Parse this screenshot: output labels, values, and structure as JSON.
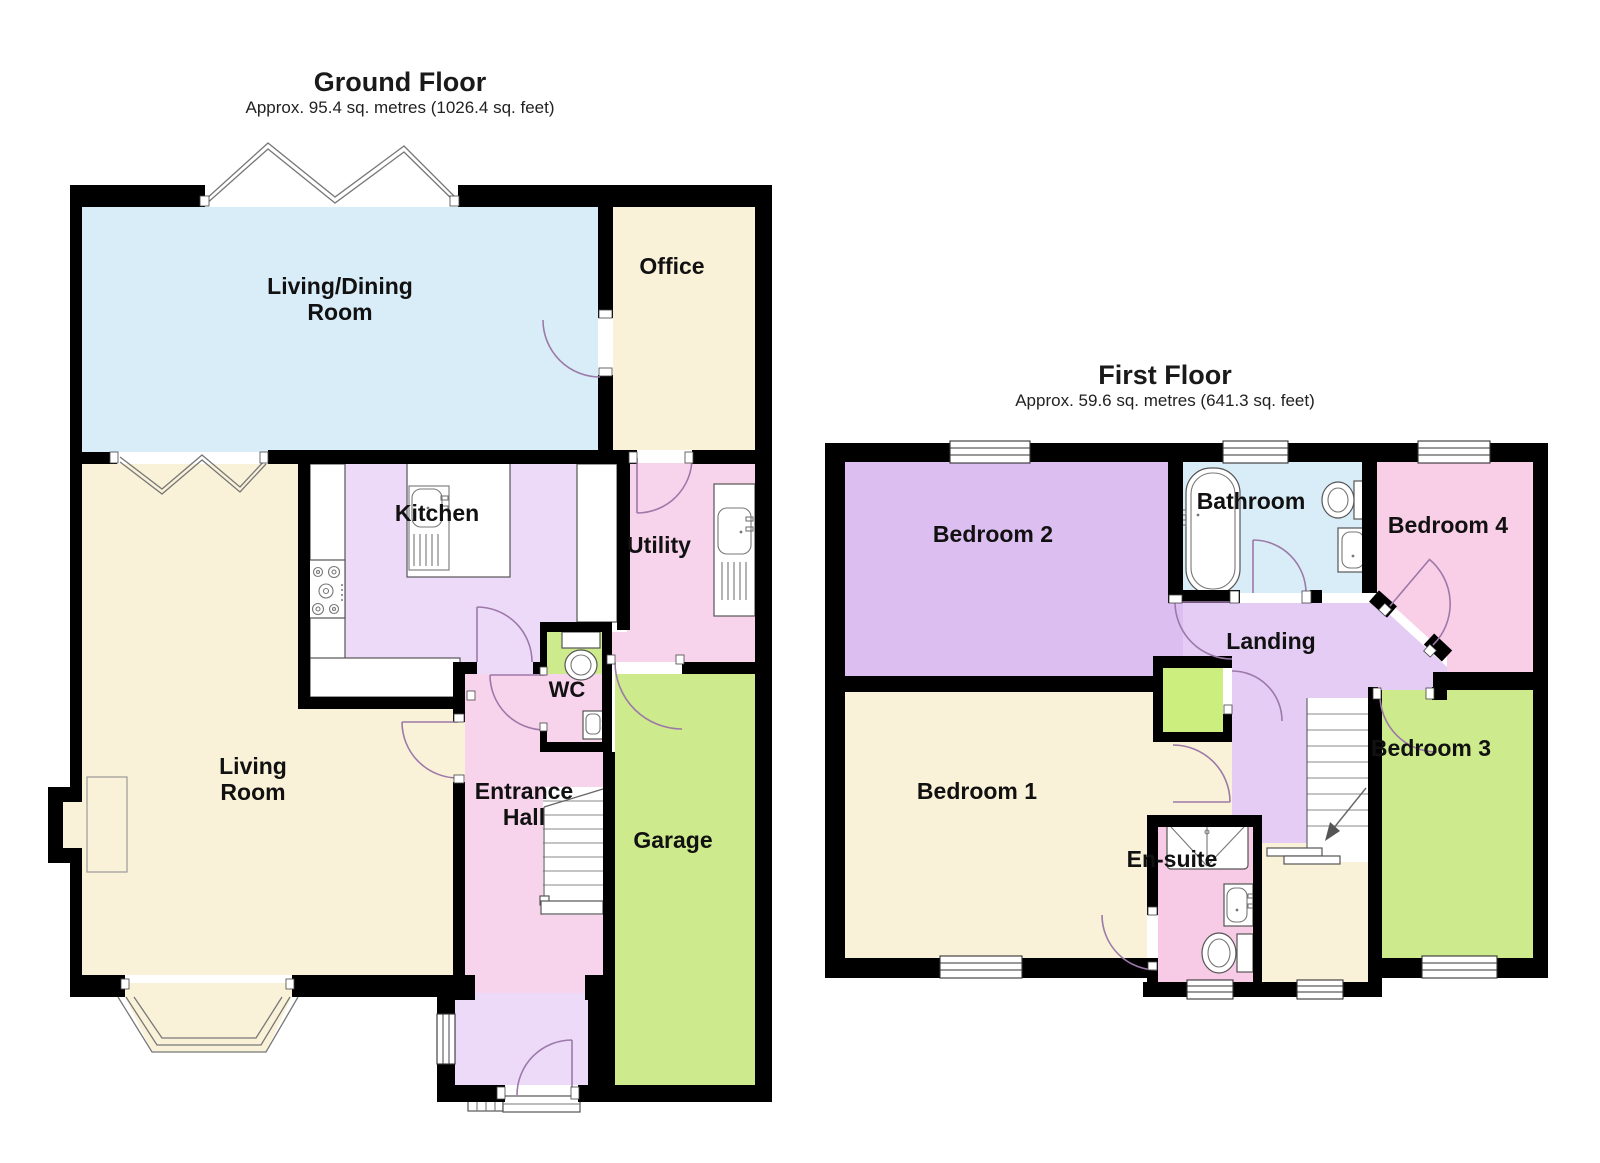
{
  "ground_floor": {
    "title": "Ground Floor",
    "subtitle": "Approx. 95.4 sq. metres (1026.4 sq. feet)",
    "rooms": {
      "living_dining": {
        "line1": "Living/Dining",
        "line2": "Room"
      },
      "office": {
        "label": "Office"
      },
      "kitchen": {
        "label": "Kitchen"
      },
      "utility": {
        "label": "Utility"
      },
      "wc": {
        "label": "WC"
      },
      "living_room": {
        "line1": "Living",
        "line2": "Room"
      },
      "entrance_hall": {
        "line1": "Entrance",
        "line2": "Hall"
      },
      "garage": {
        "label": "Garage"
      }
    }
  },
  "first_floor": {
    "title": "First Floor",
    "subtitle": "Approx. 59.6 sq. metres (641.3 sq. feet)",
    "rooms": {
      "bedroom2": {
        "label": "Bedroom 2"
      },
      "bathroom": {
        "label": "Bathroom"
      },
      "bedroom4": {
        "label": "Bedroom 4"
      },
      "landing": {
        "label": "Landing"
      },
      "bedroom1": {
        "label": "Bedroom 1"
      },
      "ensuite": {
        "label": "En-suite"
      },
      "bedroom3": {
        "label": "Bedroom 3"
      }
    }
  },
  "colors": {
    "wall": "#000000",
    "cream": "#FAF2D8",
    "light_blue": "#D9EDF8",
    "lavender": "#EDDAF8",
    "landing_lavender": "#E4CCF5",
    "bedroom2_purple": "#DCBFF0",
    "pink": "#F8D3EC",
    "bedroom4_pink": "#F9CEE7",
    "ensuite_pink": "#F7CBE6",
    "green": "#CDEA8C",
    "closet_green": "#CBEE7E",
    "door_arc": "#9C79A8"
  }
}
